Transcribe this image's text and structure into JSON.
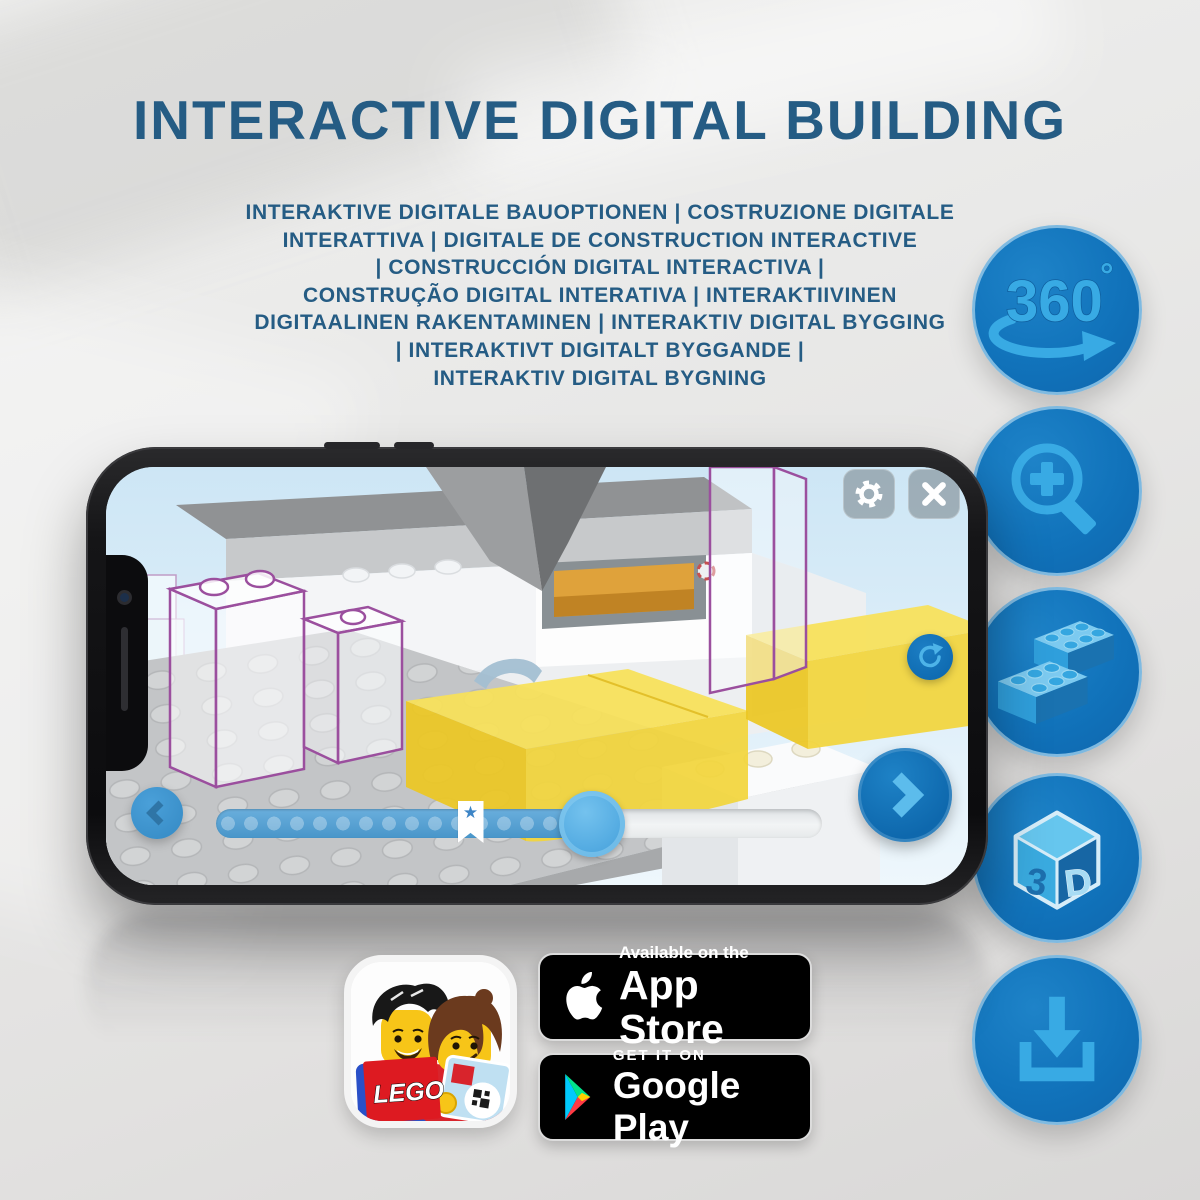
{
  "page": {
    "title": "INTERACTIVE DIGITAL BUILDING",
    "subtitle_lines": [
      "INTERAKTIVE DIGITALE BAUOPTIONEN | COSTRUZIONE DIGITALE",
      "INTERATTIVA | DIGITALE DE CONSTRUCTION INTERACTIVE",
      "| CONSTRUCCIÓN DIGITAL INTERACTIVA |",
      "CONSTRUÇÃO DIGITAL INTERATIVA | INTERAKTIIVINEN",
      "DIGITAALINEN RAKENTAMINEN | INTERAKTIV DIGITAL BYGGING",
      "| INTERAKTIVT DIGITALT BYGGANDE |",
      "INTERAKTIV DIGITAL BYGNING"
    ]
  },
  "features": {
    "rotate_label": "360",
    "rotate_degree": "°",
    "threed_left": "3",
    "threed_right": "D"
  },
  "phone": {
    "slider": {
      "progress_percent": 62,
      "bookmark_percent": 42,
      "star": "★"
    }
  },
  "store_badges": {
    "app_store": {
      "line1": "Available on the",
      "line2": "App Store"
    },
    "google_play": {
      "line1": "GET IT ON",
      "line2": "Google Play"
    }
  },
  "app_icon": {
    "logo_text": "LEGO"
  },
  "colors": {
    "heading": "#255C84",
    "icon_circle": "#1173BB",
    "icon_glyph": "#38AAE4",
    "slider_fill": "#4D9FD6",
    "lego_yellow": "#F5D42B",
    "lego_red": "#DD1A21"
  }
}
